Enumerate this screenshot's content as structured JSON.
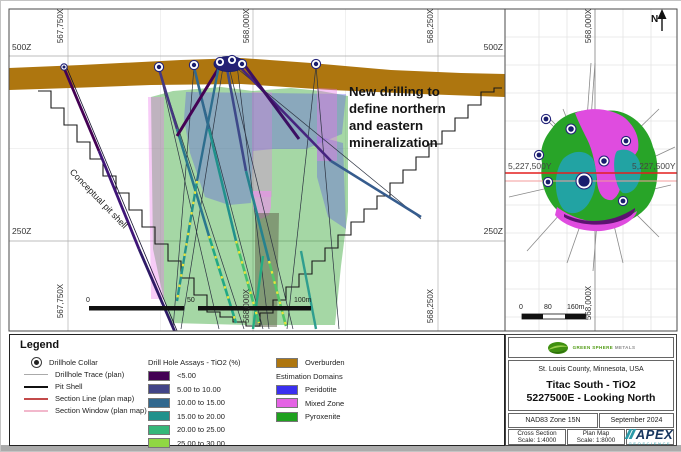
{
  "section": {
    "x_ticks": [
      "567,750X",
      "568,000X",
      "568,250X"
    ],
    "z_tick_upper": "500Z",
    "z_tick_lower": "250Z",
    "pit_label": "Conceptual pit shell",
    "annotation_lines": [
      "New drilling to",
      "define northern",
      "and eastern",
      "mineralization"
    ],
    "scale_ticks": [
      "0",
      "50",
      "100m"
    ]
  },
  "plan": {
    "x_tick": "568,000X",
    "y_tick": "5,227,500Y",
    "north_label": "N",
    "scale_ticks": [
      "0",
      "80",
      "160m"
    ]
  },
  "legend": {
    "title": "Legend",
    "symbols": [
      {
        "label": "Drillhole Collar"
      },
      {
        "label": "Drillhole Trace (plan)"
      },
      {
        "label": "Pit Shell",
        "color": "#111111"
      },
      {
        "label": "Section Line (plan map)",
        "color": "#c34a4a"
      },
      {
        "label": "Section Window (plan map)",
        "color": "#f2b8cc"
      }
    ],
    "assays": {
      "title": "Drill Hole Assays - TiO2 (%)",
      "items": [
        {
          "label": "<5.00",
          "color": "#440154"
        },
        {
          "label": "5.00 to 10.00",
          "color": "#414487"
        },
        {
          "label": "10.00 to 15.00",
          "color": "#31688e"
        },
        {
          "label": "15.00 to 20.00",
          "color": "#21918c"
        },
        {
          "label": "20.00 to 25.00",
          "color": "#35b779"
        },
        {
          "label": "25.00 to 30.00",
          "color": "#90d743"
        },
        {
          "label": ">= 30.00",
          "color": "#fde725"
        }
      ]
    },
    "overburden": {
      "label": "Overburden",
      "color": "#ae760f"
    },
    "domains": {
      "title": "Estimation Domains",
      "items": [
        {
          "label": "Peridotite",
          "color": "#3a2ff0"
        },
        {
          "label": "Mixed Zone",
          "color": "#e463e4"
        },
        {
          "label": "Pyroxenite",
          "color": "#1fa11f"
        }
      ]
    }
  },
  "title_block": {
    "company": "GREEN SPHERE",
    "company2": "METALS",
    "location": "St. Louis County, Minnesota, USA",
    "title1": "Titac South - TiO2",
    "title2": "5227500E - Looking North",
    "datum": "NAD83 Zone 15N",
    "date": "September 2024",
    "cross_section_label": "Cross Section",
    "cross_section_scale": "Scale: 1:4000",
    "plan_map_label": "Plan Map",
    "plan_map_scale": "Scale: 1:8000",
    "apex": "APEX",
    "apex_sub": "GEOSCIENCE"
  },
  "colors": {
    "overburden": "#ae760f",
    "section_line_red": "#e31f1f",
    "section_window_pink": "#f39b9b",
    "collar_navy": "#23237a",
    "plan_green": "#28a428",
    "plan_magenta": "#df4cdf",
    "plan_teal": "#22a3a3",
    "plan_dark_purple": "#5c1370"
  }
}
